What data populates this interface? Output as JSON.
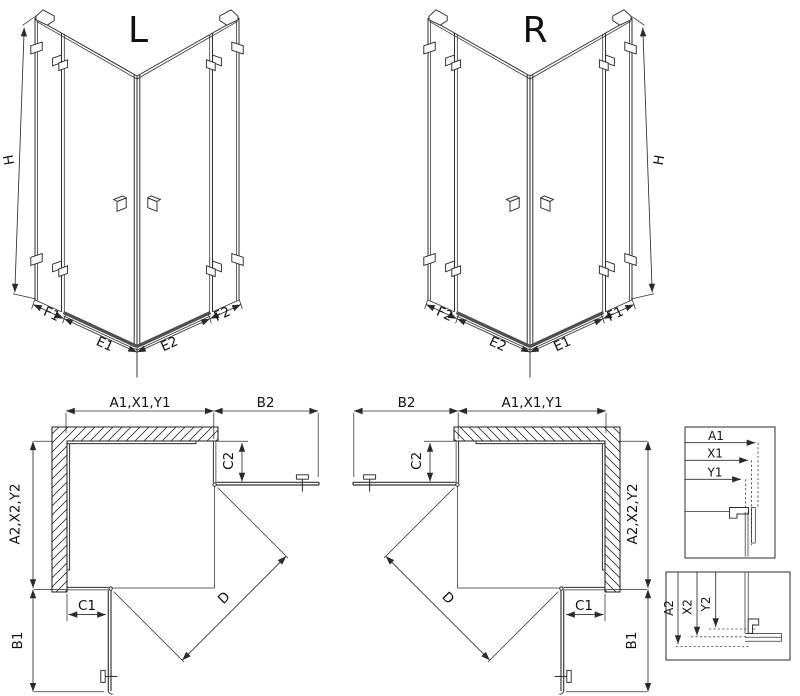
{
  "colors": {
    "line": "#2d2d2d",
    "door": "#333333",
    "threshold": "#4f4f4f",
    "text": "#111111",
    "background": "#ffffff"
  },
  "iso_left": {
    "title": "L",
    "height": "H",
    "segments": {
      "f1": "F1",
      "e1": "E1",
      "e2": "E2",
      "f2": "F2"
    }
  },
  "iso_right": {
    "title": "R",
    "height": "H",
    "segments": {
      "f2": "F2",
      "e2": "E2",
      "e1": "E1",
      "f1": "F1"
    }
  },
  "plan_left": {
    "width_top": "A1,X1,Y1",
    "door_top": "B2",
    "return_top": "C2",
    "depth_side": "A2,X2,Y2",
    "return_bottom": "C1",
    "door_bottom": "B1",
    "diagonal": "D"
  },
  "plan_right": {
    "width_top": "A1,X1,Y1",
    "door_top": "B2",
    "return_top": "C2",
    "depth_side": "A2,X2,Y2",
    "return_bottom": "C1",
    "door_bottom": "B1",
    "diagonal": "D"
  },
  "detail_width": {
    "labels": [
      "A1",
      "X1",
      "Y1"
    ]
  },
  "detail_depth": {
    "labels": [
      "A2",
      "X2",
      "Y2"
    ]
  }
}
